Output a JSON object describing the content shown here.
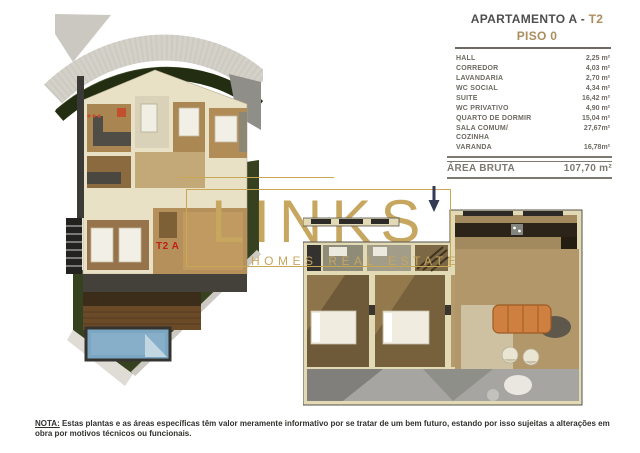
{
  "header": {
    "title_main": "APARTAMENTO A - ",
    "title_unit": "T2",
    "subtitle": "PISO 0"
  },
  "areas": {
    "rows": [
      {
        "label": "HALL",
        "value": "2,25 m²"
      },
      {
        "label": "CORREDOR",
        "value": "4,03 m²"
      },
      {
        "label": "LAVANDARIA",
        "value": "2,70 m²"
      },
      {
        "label": "WC SOCIAL",
        "value": "4,34 m²"
      },
      {
        "label": "SUITE",
        "value": "16,42 m²"
      },
      {
        "label": "WC PRIVATIVO",
        "value": "4,90 m²"
      },
      {
        "label": "QUARTO DE DORMIR",
        "value": "15,04 m²"
      },
      {
        "label": "SALA COMUM/ COZINHA",
        "value": "27,67m²"
      },
      {
        "label": "VARANDA",
        "value": "16,78m²"
      }
    ],
    "total_label": "ÁREA BRUTA",
    "total_value": "107,70 m²"
  },
  "plan_small": {
    "unit_label": "T2 A"
  },
  "watermark": {
    "brand": "LINKS",
    "tagline": "HOMES REAL ESTATE"
  },
  "note": {
    "prefix": "NOTA:",
    "text": " Estas plantas e as áreas específicas têm valor  meramente informativo por se tratar de um bem  futuro, estando por isso sujeitas a alterações em  obra por motivos técnicos ou funcionais."
  },
  "colors": {
    "brand_gold": "#c7a65f",
    "header_gold": "#ab8d5e",
    "header_dark": "#4e4e4e",
    "table_gray": "#6e6a63",
    "unit_red": "#c01f1a",
    "arrow_navy": "#323a54"
  }
}
